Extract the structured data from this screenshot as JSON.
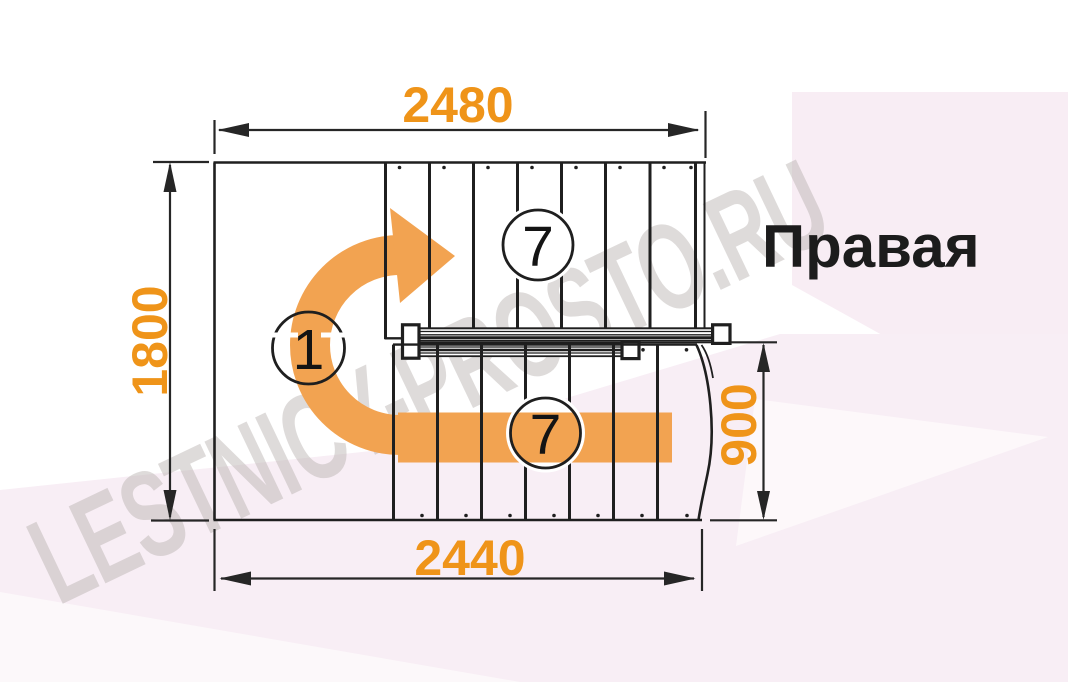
{
  "drawing": {
    "type": "stair-plan-top-view",
    "orientation_label": "Правая",
    "watermark_text": "LESTNICY-PROSTO.RU",
    "dimensions": {
      "top_width": "2480",
      "left_height": "1800",
      "right_flight_width": "900",
      "bottom_width": "2440"
    },
    "markers": {
      "upper_flight_steps": "7",
      "turn_landing": "1",
      "lower_flight_steps": "7"
    },
    "colors": {
      "dimension_text": "#ef9419",
      "direction_arrow": "#f2a351",
      "line": "#1f1f1f",
      "accent_background": "#f8eef5",
      "watermark": "#b3aca9"
    }
  }
}
